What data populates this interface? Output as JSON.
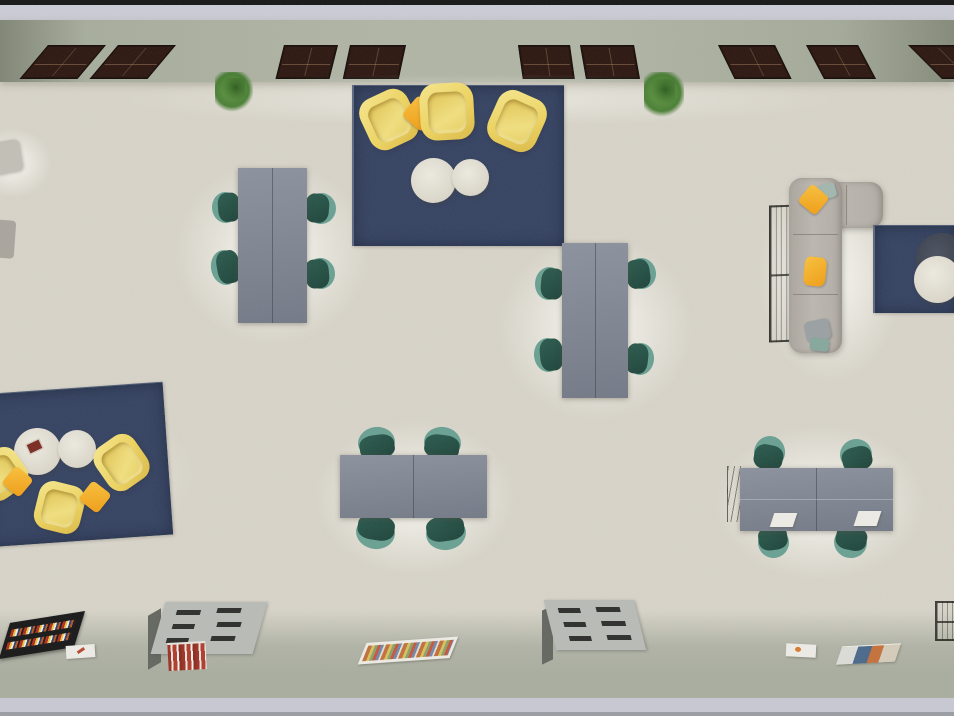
{
  "scene": {
    "title": "Top-down 3D render of a furnished open reading room",
    "view": "overhead floor-plan render",
    "zones": [
      "window wall (top)",
      "main beige floor",
      "bottom walkway with low bookshelves"
    ],
    "objects": [
      {
        "name": "dark-frame-windows",
        "count": 9
      },
      {
        "name": "potted-plants",
        "count": 2
      },
      {
        "name": "navy-area-rugs",
        "count": 3
      },
      {
        "name": "yellow-lounge-chairs",
        "count": 6
      },
      {
        "name": "orange-throw-pillows",
        "count": 4
      },
      {
        "name": "round-white-coffee-tables",
        "count": 5
      },
      {
        "name": "round-dark-table",
        "count": 1
      },
      {
        "name": "gray-study-tables",
        "count": 4
      },
      {
        "name": "teal-desk-chairs",
        "count": 16
      },
      {
        "name": "l-shaped-greige-sofa",
        "count": 1
      },
      {
        "name": "wire-frame-shelves",
        "count": 3
      },
      {
        "name": "low-bookshelf-units",
        "count": 2
      },
      {
        "name": "flat-book-display-trays",
        "count": 2
      },
      {
        "name": "loose-papers-magazines",
        "count": 4
      },
      {
        "name": "laptops-on-desk",
        "count": 2
      }
    ]
  },
  "colors": {
    "floor": "#d8d4c9",
    "top_black": "#141414",
    "top_strip": "#cbccd6",
    "wall_band": "#b0b5a5",
    "walkway": "#a9ad9f",
    "bottom_strip": "#c9c9d3",
    "bottom_edge": "#9b9da4",
    "window_brown": "#2b140e",
    "rug_navy": "#334160",
    "armchair_yellow": "#eed45e",
    "pillow_orange": "#f09d12",
    "table_gray": "#7c838f",
    "chair_teal": "#1c4238",
    "chair_teal_light": "#68a092",
    "sofa_greige": "#bcb7af",
    "circle_white": "#dcd8cb",
    "circle_dark": "#353a47",
    "shelf_gray": "#b9bbb7",
    "shelf_side": "#63665f",
    "paper_white": "#eeece6",
    "plant_green": "#3c7627"
  }
}
